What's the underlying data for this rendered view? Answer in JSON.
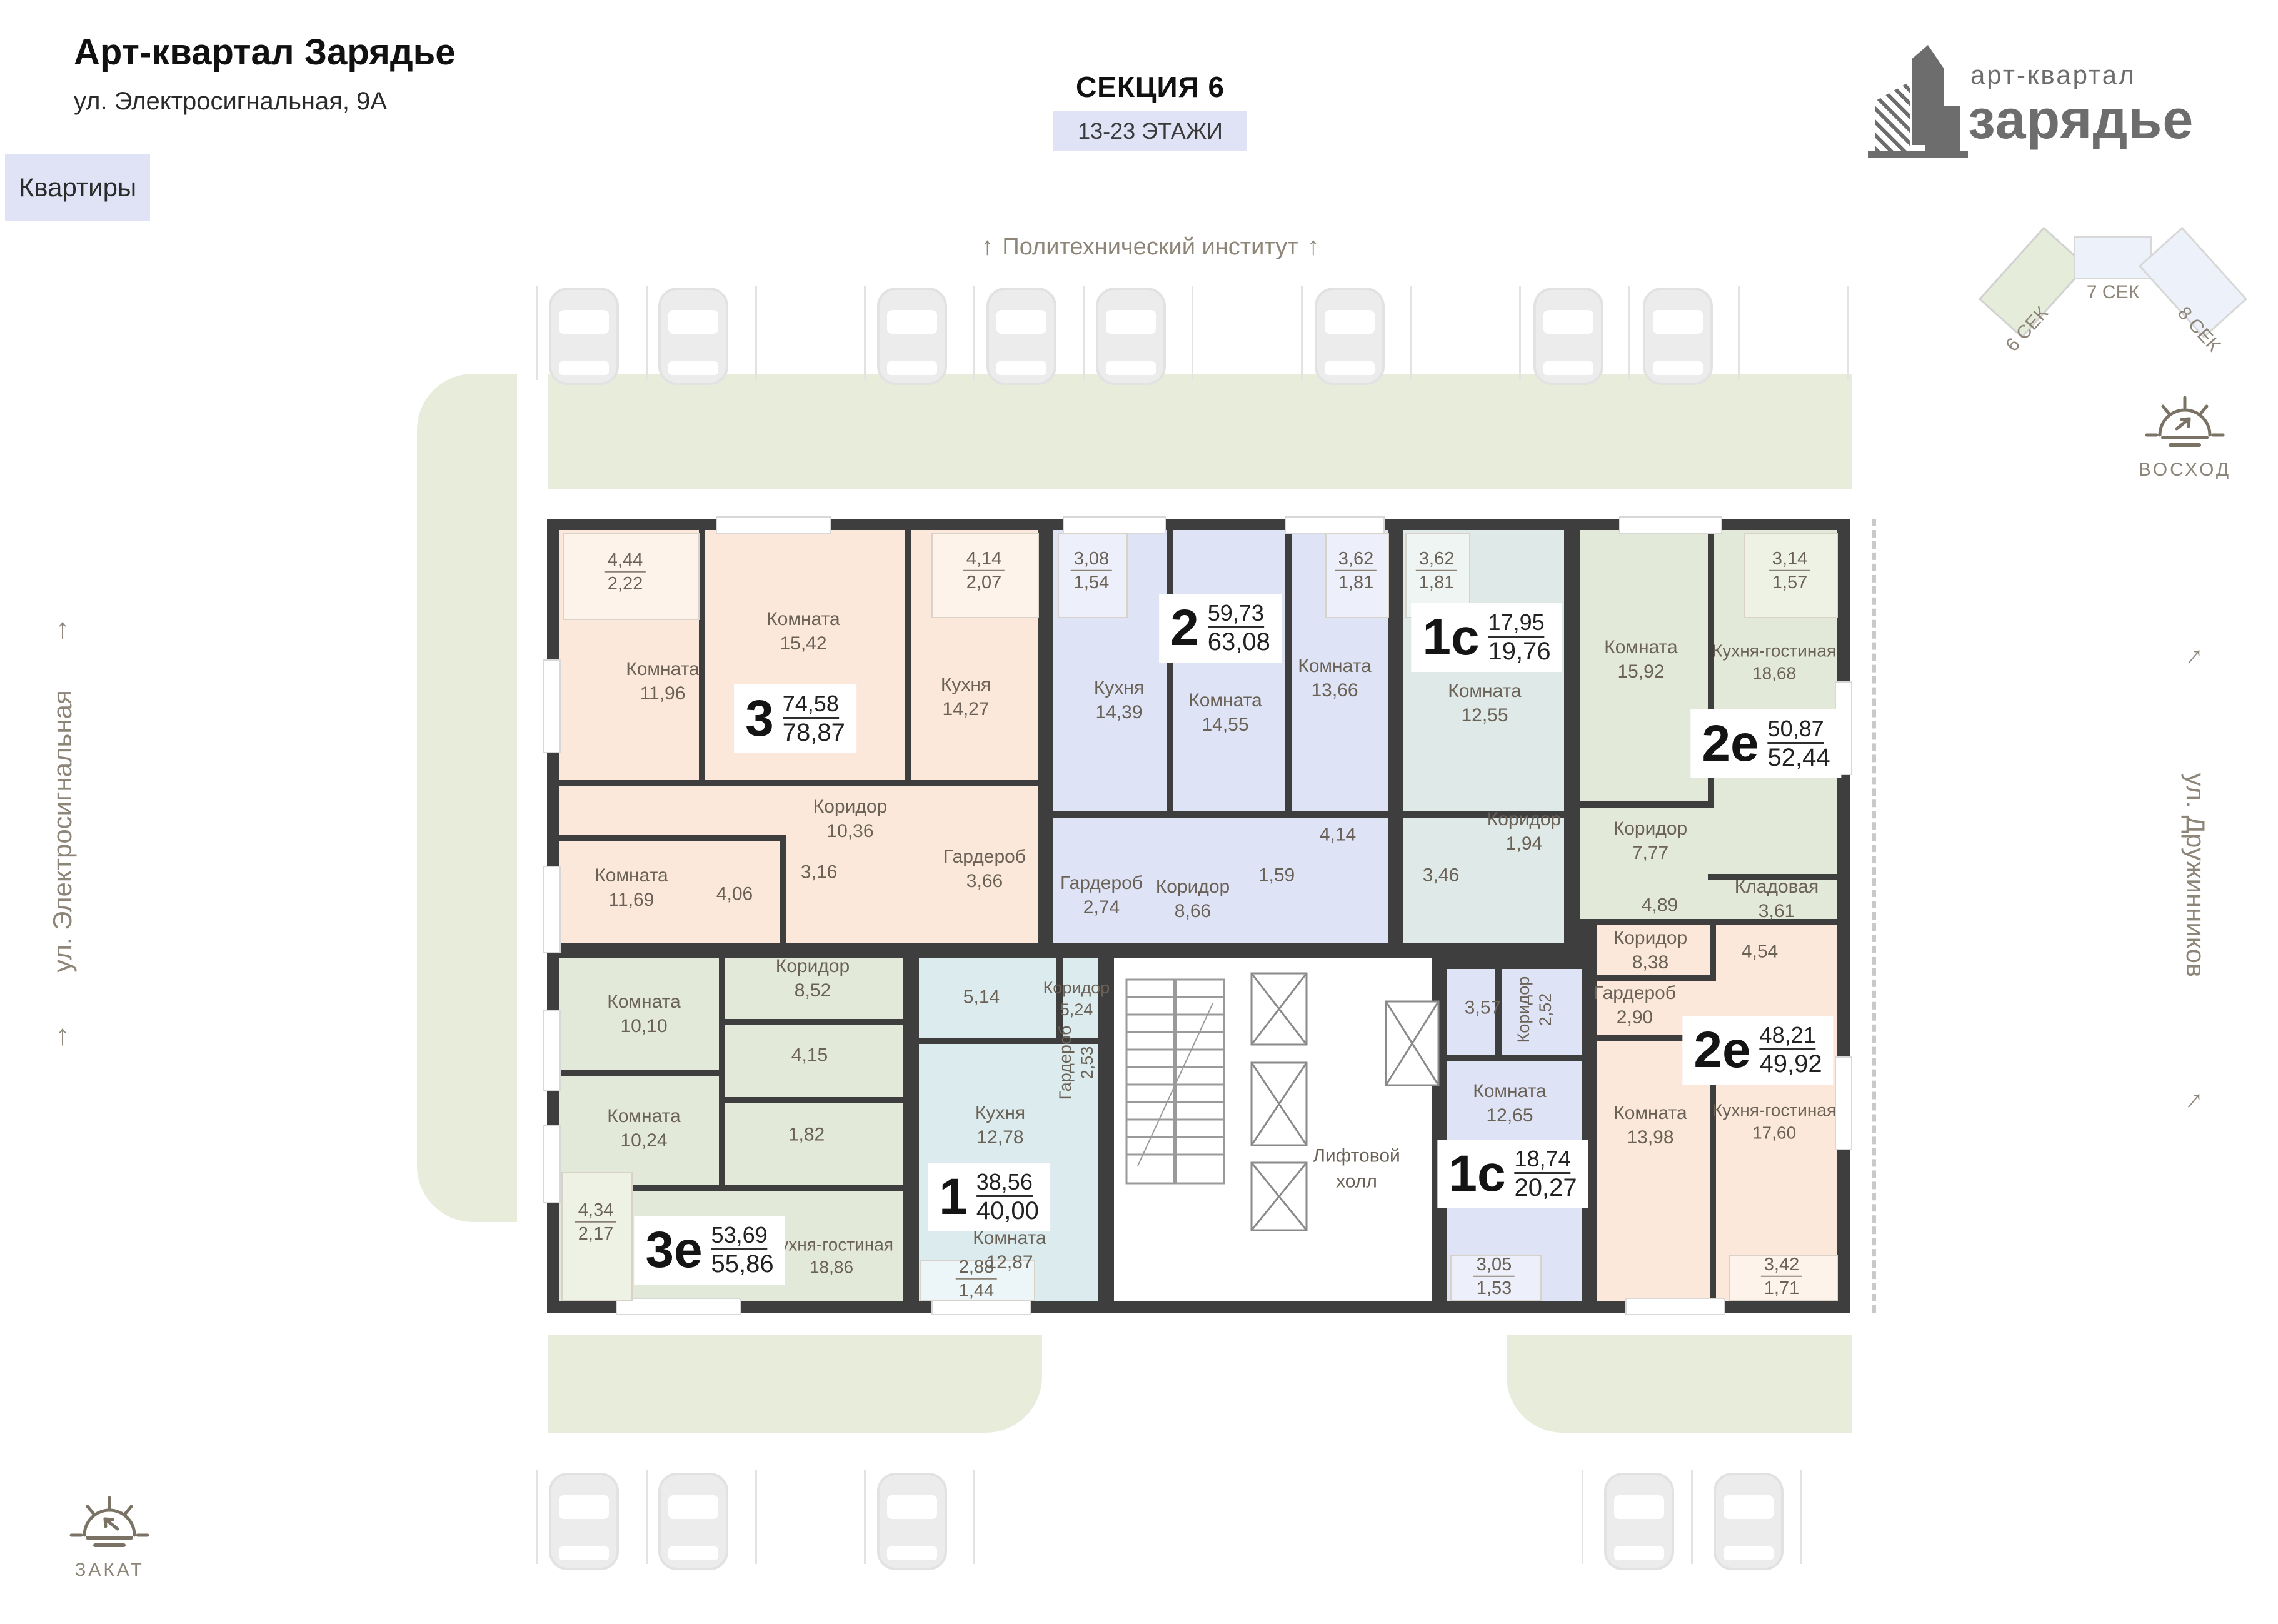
{
  "header": {
    "title": "Арт-квартал Зарядье",
    "subtitle": "ул. Электросигнальная, 9А",
    "tab": "Квартиры",
    "section_title": "СЕКЦИЯ 6",
    "floors_chip": "13-23 ЭТАЖИ",
    "landmark_top": "Политехнический институт"
  },
  "logo": {
    "line1": "арт-квартал",
    "line2": "зарядье"
  },
  "section_map": {
    "s6": "6 СЕК",
    "s7": "7 СЕК",
    "s8": "8 СЕК",
    "active": "6 СЕК"
  },
  "compass": {
    "sunrise": "ВОСХОД",
    "sunset": "ЗАКАТ"
  },
  "streets": {
    "left": "ул. Электросигнальная",
    "right": "ул. Дружинников"
  },
  "icons": {
    "arrow_up": "↑"
  },
  "colors": {
    "wall": "#3e3e3e",
    "landscape": "#e7ecdb",
    "chip": "#dfe3f5",
    "apt_peach": "#fbe8db",
    "apt_lavender": "#dfe3f6",
    "apt_cyan": "#dfeae8",
    "apt_green": "#e3e9d8",
    "apt_blue": "#dcebee",
    "text_muted": "#8d8578"
  },
  "plan": {
    "core": {
      "elevator_hall": "Лифтовой холл"
    },
    "apartments": [
      {
        "type": "3",
        "area1": "74,58",
        "area2": "78,87",
        "rooms": [
          {
            "n": "Комната",
            "v": "11,96"
          },
          {
            "n": "Комната",
            "v": "15,42"
          },
          {
            "n": "Кухня",
            "v": "14,27"
          },
          {
            "n": "Коридор",
            "v": "10,36"
          },
          {
            "n": "Комната",
            "v": "11,69"
          },
          {
            "n": "",
            "v": "4,06"
          },
          {
            "n": "",
            "v": "3,16"
          },
          {
            "n": "Гардероб",
            "v": "3,66"
          }
        ],
        "balconies": [
          {
            "a": "4,44",
            "b": "2,22"
          },
          {
            "a": "4,14",
            "b": "2,07"
          }
        ]
      },
      {
        "type": "2",
        "area1": "59,73",
        "area2": "63,08",
        "rooms": [
          {
            "n": "Кухня",
            "v": "14,39"
          },
          {
            "n": "Комната",
            "v": "14,55"
          },
          {
            "n": "Комната",
            "v": "13,66"
          },
          {
            "n": "Гардероб",
            "v": "2,74"
          },
          {
            "n": "Коридор",
            "v": "8,66"
          },
          {
            "n": "",
            "v": "1,59"
          },
          {
            "n": "",
            "v": "4,14"
          }
        ],
        "balconies": [
          {
            "a": "3,08",
            "b": "1,54"
          },
          {
            "a": "3,62",
            "b": "1,81"
          }
        ]
      },
      {
        "type": "1с",
        "area1": "17,95",
        "area2": "19,76",
        "rooms": [
          {
            "n": "Комната",
            "v": "12,55"
          },
          {
            "n": "Коридор",
            "v": "1,94"
          },
          {
            "n": "",
            "v": "3,46"
          }
        ],
        "balconies": [
          {
            "a": "3,62",
            "b": "1,81"
          }
        ]
      },
      {
        "type": "2е",
        "area1": "50,87",
        "area2": "52,44",
        "rooms": [
          {
            "n": "Комната",
            "v": "15,92"
          },
          {
            "n": "Кухня-гостиная",
            "v": "18,68"
          },
          {
            "n": "Коридор",
            "v": "7,77"
          },
          {
            "n": "",
            "v": "4,89"
          },
          {
            "n": "Кладовая",
            "v": "3,61"
          }
        ],
        "balconies": [
          {
            "a": "3,14",
            "b": "1,57"
          }
        ]
      },
      {
        "type": "3е",
        "area1": "53,69",
        "area2": "55,86",
        "rooms": [
          {
            "n": "Коридор",
            "v": "8,52"
          },
          {
            "n": "Комната",
            "v": "10,10"
          },
          {
            "n": "Комната",
            "v": "10,24"
          },
          {
            "n": "",
            "v": "4,15"
          },
          {
            "n": "",
            "v": "1,82"
          },
          {
            "n": "Кухня-гостиная",
            "v": "18,86"
          }
        ],
        "balconies": [
          {
            "a": "4,34",
            "b": "2,17"
          }
        ]
      },
      {
        "type": "1",
        "area1": "38,56",
        "area2": "40,00",
        "rooms": [
          {
            "n": "",
            "v": "5,14"
          },
          {
            "n": "Коридор",
            "v": "5,24"
          },
          {
            "n": "Гардероб",
            "v": "2,53"
          },
          {
            "n": "Кухня",
            "v": "12,78"
          },
          {
            "n": "Комната",
            "v": "12,87"
          }
        ],
        "balconies": [
          {
            "a": "2,88",
            "b": "1,44"
          }
        ]
      },
      {
        "type": "1с",
        "area1": "18,74",
        "area2": "20,27",
        "rooms": [
          {
            "n": "",
            "v": "3,57"
          },
          {
            "n": "Коридор",
            "v": "2,52"
          },
          {
            "n": "Комната",
            "v": "12,65"
          }
        ],
        "balconies": [
          {
            "a": "3,05",
            "b": "1,53"
          }
        ]
      },
      {
        "type": "2е",
        "area1": "48,21",
        "area2": "49,92",
        "rooms": [
          {
            "n": "Коридор",
            "v": "8,38"
          },
          {
            "n": "",
            "v": "4,54"
          },
          {
            "n": "Гардероб",
            "v": "2,90"
          },
          {
            "n": "Комната",
            "v": "13,98"
          },
          {
            "n": "Кухня-гостиная",
            "v": "17,60"
          }
        ],
        "balconies": [
          {
            "a": "3,42",
            "b": "1,71"
          }
        ]
      }
    ]
  }
}
